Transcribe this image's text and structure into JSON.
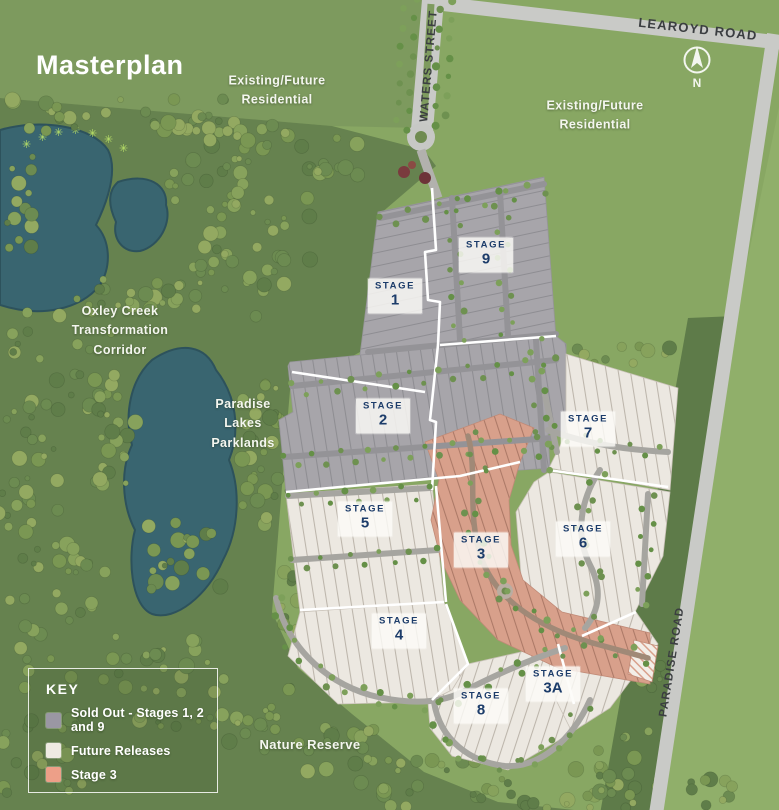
{
  "title": "Masterplan",
  "compass": {
    "north": "N"
  },
  "roads": {
    "learoyd": "LEAROYD ROAD",
    "waters": "WATERS STREET",
    "paradise": "PARADISE ROAD"
  },
  "areas": {
    "residential_nw": {
      "line1": "Existing/Future",
      "line2": "Residential"
    },
    "residential_ne": {
      "line1": "Existing/Future",
      "line2": "Residential"
    },
    "oxley": {
      "line1": "Oxley Creek",
      "line2": "Transformation",
      "line3": "Corridor"
    },
    "parklands": {
      "line1": "Paradise",
      "line2": "Lakes",
      "line3": "Parklands"
    },
    "nature_reserve": "Nature Reserve"
  },
  "stages": [
    {
      "label": "STAGE",
      "num": "1"
    },
    {
      "label": "STAGE",
      "num": "9"
    },
    {
      "label": "STAGE",
      "num": "2"
    },
    {
      "label": "STAGE",
      "num": "7"
    },
    {
      "label": "STAGE",
      "num": "5"
    },
    {
      "label": "STAGE",
      "num": "3"
    },
    {
      "label": "STAGE",
      "num": "6"
    },
    {
      "label": "STAGE",
      "num": "4"
    },
    {
      "label": "STAGE",
      "num": "3A"
    },
    {
      "label": "STAGE",
      "num": "8"
    }
  ],
  "legend": {
    "title": "KEY",
    "items": [
      {
        "color": "#9a97a3",
        "label": "Sold Out - Stages 1, 2 and 9"
      },
      {
        "color": "#eeeae3",
        "label": "Future Releases"
      },
      {
        "color": "#ed9f88",
        "label": "Stage 3"
      }
    ]
  },
  "colors": {
    "background_green": "#88a763",
    "nature_green": "#66824f",
    "water": "#396570",
    "sold_out": "#a7a5aa",
    "future_release": "#ece8e1",
    "stage3": "#d8a08b",
    "road": "#c9cac7",
    "badge_text": "#1c3c6a"
  }
}
